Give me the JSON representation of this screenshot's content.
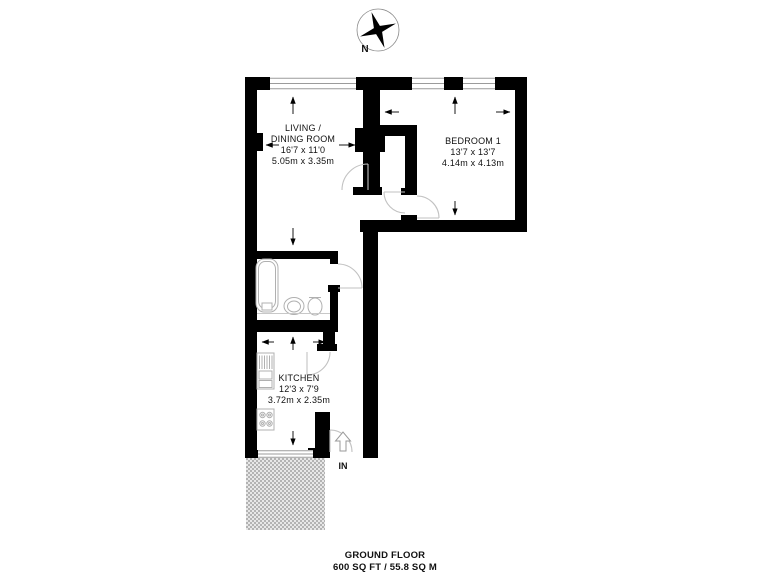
{
  "floorplan": {
    "compass_label": "N",
    "entrance_label": "IN",
    "rooms": [
      {
        "id": "living-dining-room",
        "lines": [
          "LIVING /",
          "DINING ROOM",
          "16'7 x 11'0",
          "5.05m x 3.35m"
        ]
      },
      {
        "id": "bedroom-1",
        "lines": [
          "BEDROOM 1",
          "13'7 x 13'7",
          "4.14m x 4.13m"
        ]
      },
      {
        "id": "kitchen",
        "lines": [
          "KITCHEN",
          "12'3 x 7'9",
          "3.72m x 2.35m"
        ]
      }
    ],
    "footer": {
      "title": "GROUND FLOOR",
      "area": "600 SQ FT / 55.8 SQ M"
    },
    "colors": {
      "walls": "#000000",
      "window_lines": "#9b9b9b",
      "door_lines": "#c2c2c2",
      "fixture_lines": "#b0b0b0",
      "terrace_fill": "#bdbdbd",
      "text": "#111111"
    }
  }
}
